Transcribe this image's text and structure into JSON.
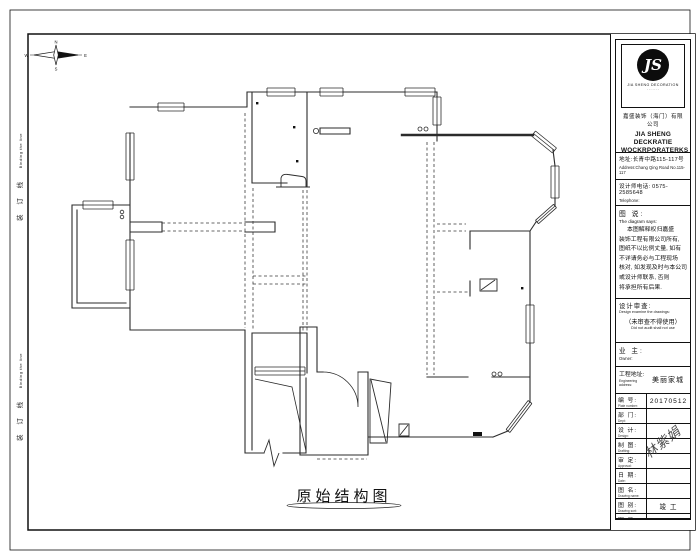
{
  "sheet": {
    "drawing_title": "原始结构图",
    "binding_line_cn": "装 订 线",
    "binding_line_en": "Binding the line"
  },
  "compass": {
    "n": "N",
    "e": "E",
    "s": "S",
    "w": "W"
  },
  "titleblock": {
    "logo": {
      "monogram": "JS",
      "caption": "JIA SHENG DECORATION",
      "subcaption": "· · · · · · ·"
    },
    "company_cn": "嘉盛装饰（海门）有限公司",
    "company_en_1": "JIA SHENG DECKRATIE",
    "company_en_2": "WOCKRPORATERKS",
    "address_cn": "地址:长青中路115-117号",
    "address_en": "Address:Chang Qing Road No.115-117",
    "phone_cn": "设计师电话: 0575-2585648",
    "phone_en": "Telephone:",
    "says_label_cn": "图 说:",
    "says_label_en": "The diagram says:",
    "says_lines": [
      "本图解释权归嘉盛",
      "装饰工程有限公司所有,",
      "图纸不以比例丈量, 如有",
      "不详请务必与工程现场",
      "核对, 如发现及时与本公司",
      "或设计师联系, 否则",
      "将承担所有后果."
    ],
    "review_cn": "设计审查:",
    "review_en": "Design examine the drawings:",
    "review_note_cn": "（未审查不得使用）",
    "review_note_en": "Did not audit shall not use",
    "owner_cn": "业 主:",
    "owner_en": "Owner:",
    "site_cn": "工程地址:",
    "site_en": "Engineering address:",
    "site_value": "美丽家城",
    "rows": [
      {
        "cn": "编 号:",
        "en": "Plate number:",
        "value": "20170512"
      },
      {
        "cn": "部 门:",
        "en": "Dept:",
        "value": ""
      },
      {
        "cn": "设 计:",
        "en": "Design:",
        "value": ""
      },
      {
        "cn": "制 图:",
        "en": "Drafting:",
        "value": ""
      },
      {
        "cn": "审 定:",
        "en": "Approval:",
        "value": ""
      },
      {
        "cn": "日 期:",
        "en": "Date:",
        "value": ""
      },
      {
        "cn": "图 名:",
        "en": "Drawing name:",
        "value": ""
      },
      {
        "cn": "图 别:",
        "en": "Drawing sort:",
        "value": "竣 工"
      },
      {
        "cn": "图 号:",
        "en": "Drawing number:",
        "value": "PM 01"
      }
    ],
    "signature": "林紫娟"
  }
}
